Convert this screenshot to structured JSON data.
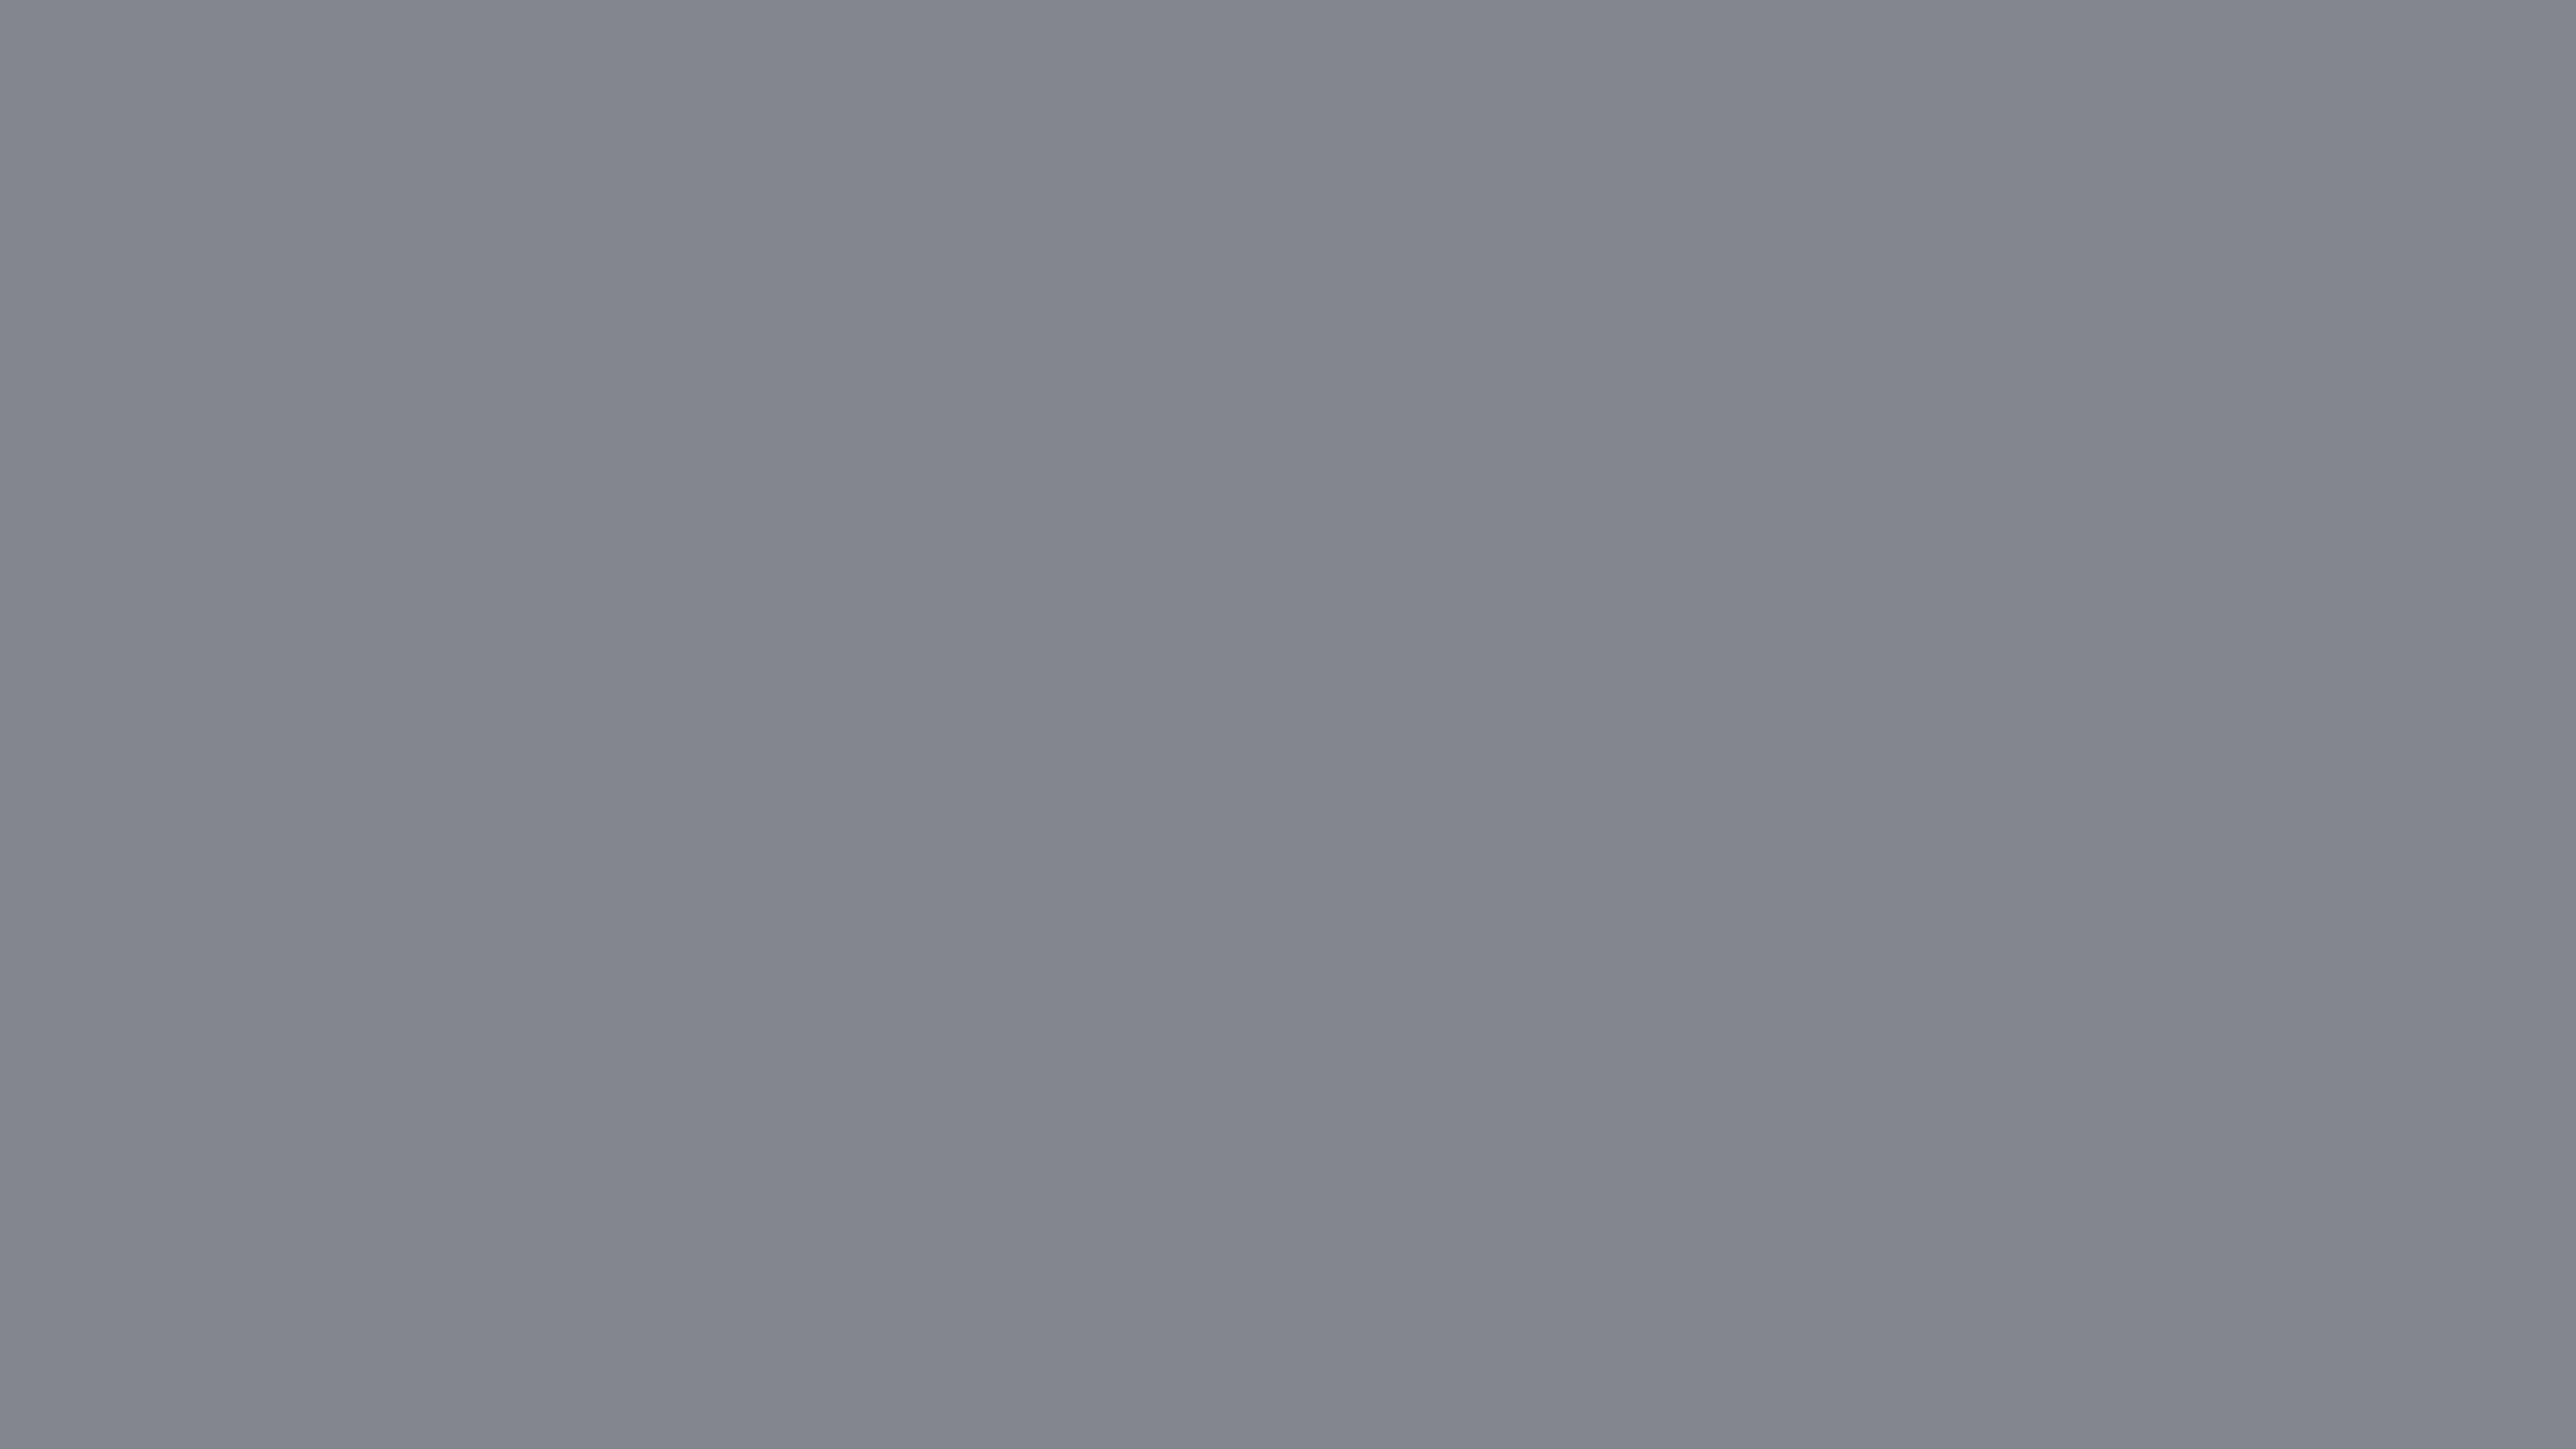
{
  "scene": {
    "title": "3D isometric floor plan of a one-bedroom apartment",
    "description": "Dollhouse cutaway render: white walls on a gray backdrop, wood floors, kitchen with gray cabinets, living room with sofa and wall art, round dining table with chairs, media wall with TV, bedroom with gray duvet bed and wardrobe, dark tiled bathroom with glass shower and tub, and a balcony with railing and potted plants.",
    "view": "isometric from above",
    "background": "plain gray with long soft building shadow cast to the right"
  },
  "palette": {
    "background": "#84868e",
    "shadow": "#3c4860",
    "wall_white": "#f6f8fb",
    "wall_cap": "#e6eaf1",
    "wall_shaded": "#a2aab8",
    "dark_tile": "#2d333e",
    "wood_floor": "#a97a52",
    "bath_floor": "#55595f",
    "balcony_floor": "#b6bbc5",
    "cabinet_gray": "#bcc2cd",
    "counter_dark": "#4a4f57",
    "sofa": "#e6eaf2",
    "accent_slate": "#66757f",
    "duvet": "#65696e",
    "table_wood": "#7d5f49",
    "plant_green": "#3f8a3c",
    "frame_wood": "#b08a5e"
  },
  "rooms": [
    {
      "name": "Living room",
      "items": [
        "sofa with pillows and throw",
        "floor lamp",
        "abstract wall art",
        "round dining table",
        "4 dining chairs",
        "media wall with TV"
      ]
    },
    {
      "name": "Kitchen",
      "items": [
        "tall oven cabinet",
        "upper cabinets",
        "base cabinets with cooktop",
        "corner counter with sink",
        "dark backsplash"
      ]
    },
    {
      "name": "Bedroom",
      "items": [
        "double bed with gray duvet",
        "wood wardrobe",
        "open glass door to balcony"
      ]
    },
    {
      "name": "Bathroom",
      "items": [
        "dark mosaic tile walls",
        "bathtub",
        "glass shower screen",
        "open white door"
      ]
    },
    {
      "name": "Hallway",
      "items": [
        "open wood shelving units",
        "doorways"
      ]
    },
    {
      "name": "Balcony",
      "items": [
        "metal railing",
        "potted palm plant",
        "small corner plant",
        "tiled floor",
        "french glass doors"
      ]
    }
  ],
  "counts": {
    "dining_chairs": 4,
    "sofa_pillows": 3,
    "plants": 2,
    "glass_door_sets": 2,
    "wall_shafts": 2
  }
}
